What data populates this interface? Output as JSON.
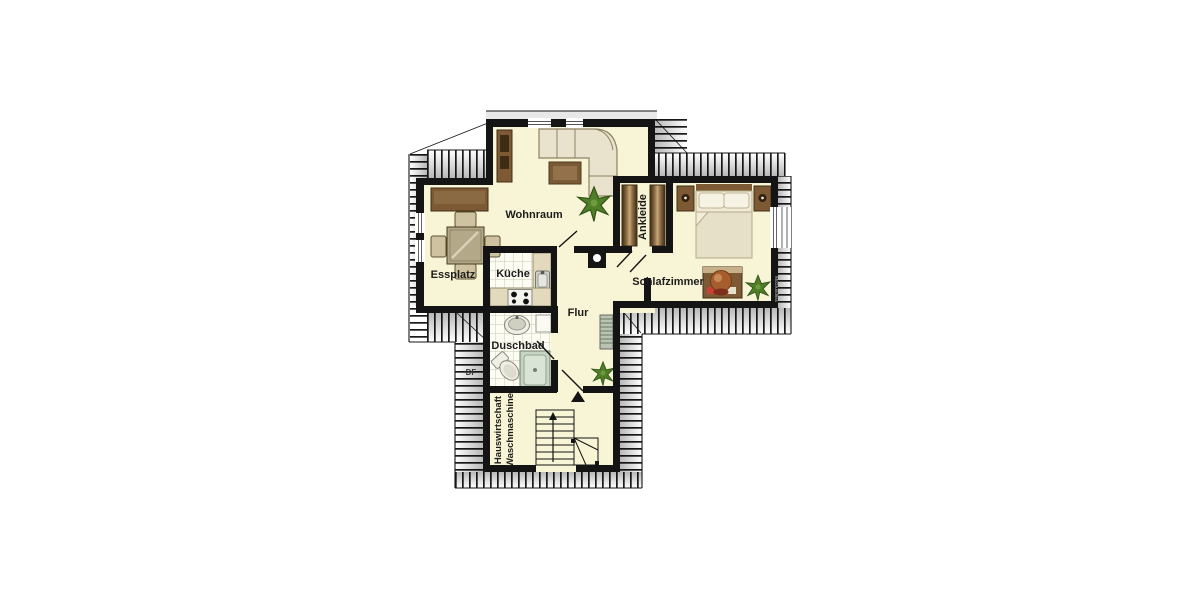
{
  "plan": {
    "type": "floor-plan",
    "rooms": {
      "wohnraum": "Wohnraum",
      "essplatz": "Essplatz",
      "kueche": "Küche",
      "flur": "Flur",
      "duschbad": "Duschbad",
      "ankleide": "Ankleide",
      "schlafzimmer": "Schlafzimmer",
      "hauswirtschaft_line1": "Hauswirtschaft",
      "hauswirtschaft_line2": "Waschmaschine"
    },
    "annotations": {
      "roof_window": "DF",
      "watermark": "McGrundriss"
    },
    "colors": {
      "floor": "#f8f4d6",
      "wall": "#141414",
      "wood": "#7d5a33",
      "wood_dark": "#3f2d15",
      "sofa": "#e9e2cc",
      "plant": "#4f7d28",
      "shower": "#c6d4c4",
      "terracotta": "#a65f2c",
      "tile_line": "#c9c9b4"
    }
  }
}
